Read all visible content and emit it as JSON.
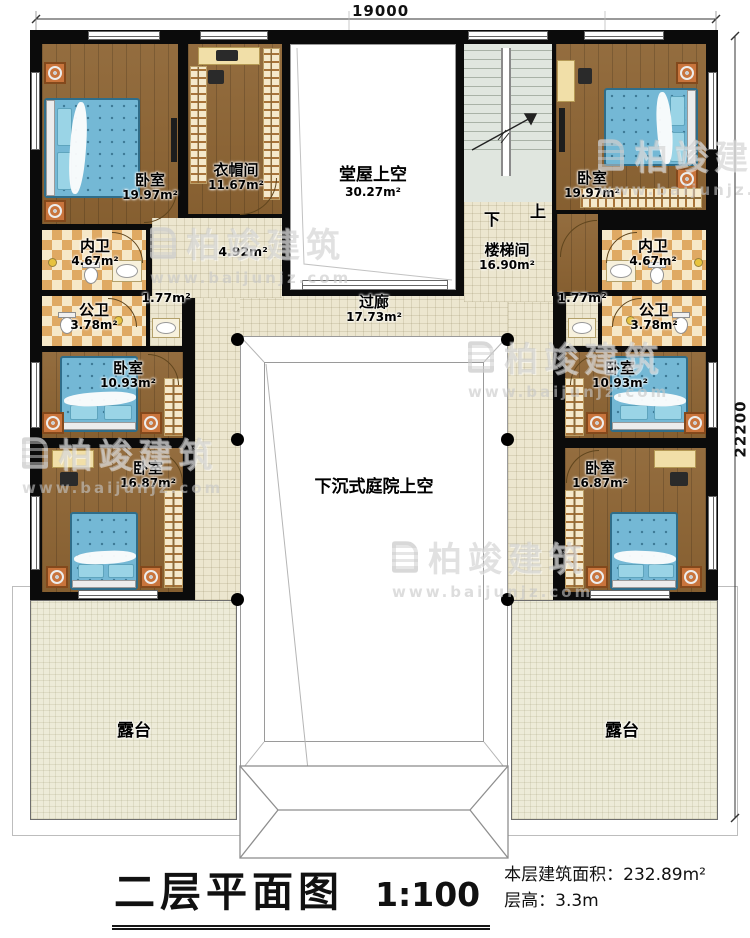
{
  "dimensions": {
    "top": "19000",
    "right": "22200"
  },
  "rooms": {
    "bedroom_tl": {
      "label": "卧室",
      "area": "19.97m²"
    },
    "bedroom_tr": {
      "label": "卧室",
      "area": "19.97m²"
    },
    "closet": {
      "label": "衣帽间",
      "area": "11.67m²"
    },
    "hall_void": {
      "label": "堂屋上空",
      "area": "30.27m²"
    },
    "stair_hall": {
      "label": "楼梯间",
      "area": "16.90m²"
    },
    "bath_inner_l": {
      "label": "内卫",
      "area": "4.67m²"
    },
    "bath_inner_r": {
      "label": "内卫",
      "area": "4.67m²"
    },
    "bath_public_l": {
      "label": "公卫",
      "area": "3.78m²"
    },
    "bath_public_r": {
      "label": "公卫",
      "area": "3.78m²"
    },
    "vanity_l": {
      "area": "1.77m²"
    },
    "vanity_r": {
      "area": "1.77m²"
    },
    "corridor_small": {
      "area": "4.92m²"
    },
    "bedroom_ml": {
      "label": "卧室",
      "area": "10.93m²"
    },
    "bedroom_mr": {
      "label": "卧室",
      "area": "10.93m²"
    },
    "bedroom_bl": {
      "label": "卧室",
      "area": "16.87m²"
    },
    "bedroom_br": {
      "label": "卧室",
      "area": "16.87m²"
    },
    "corridor": {
      "label": "过廊",
      "area": "17.73m²"
    },
    "courtyard": {
      "label": "下沉式庭院上空"
    },
    "terrace_l": {
      "label": "露台"
    },
    "terrace_r": {
      "label": "露台"
    }
  },
  "stairs": {
    "down_label": "下",
    "up_label": "上"
  },
  "title": {
    "name": "二层平面图",
    "scale": "1:100",
    "floor_area": "本层建筑面积：232.89m²",
    "floor_height": "层高：3.3m"
  },
  "watermark": {
    "brand": "柏竣建筑",
    "url": "www.baijunjz.com"
  }
}
